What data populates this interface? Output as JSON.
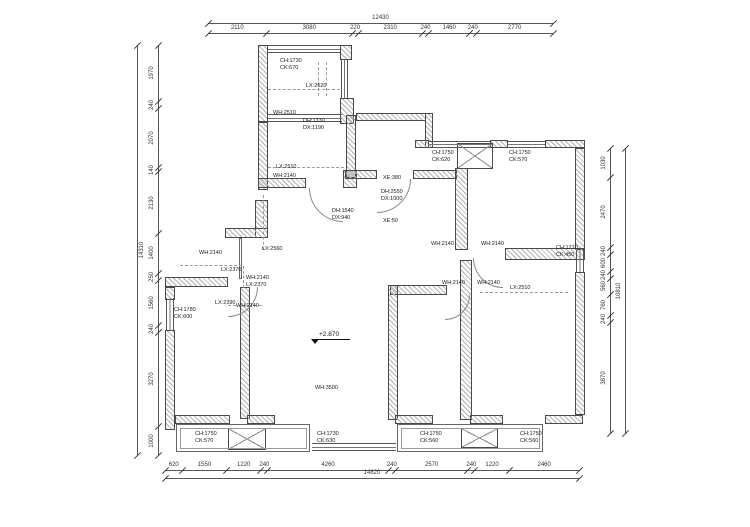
{
  "drawing": {
    "level_marker": "+2.870",
    "dimensions": {
      "top": {
        "total": "12430",
        "segments": [
          "2110",
          "3080",
          "220",
          "2310",
          "240",
          "1460",
          "240",
          "2770"
        ]
      },
      "bottom": {
        "total": "14820",
        "segments": [
          "620",
          "1550",
          "1220",
          "240",
          "4260",
          "240",
          "2570",
          "240",
          "1220",
          "2460"
        ]
      },
      "left": {
        "total": "14310",
        "segments": [
          "1970",
          "240",
          "2070",
          "140",
          "2130",
          "1400",
          "250",
          "1560",
          "240",
          "3270",
          "1000"
        ]
      },
      "right": {
        "total": "10810",
        "segments": [
          "1030",
          "2470",
          "240",
          "600",
          "240",
          "560",
          "760",
          "240",
          "3870"
        ]
      }
    },
    "annotations": [
      {
        "x": 280,
        "y": 58,
        "lines": [
          "CH:1730",
          "CK:670"
        ]
      },
      {
        "x": 306,
        "y": 83,
        "lines": [
          "LX:2620"
        ]
      },
      {
        "x": 273,
        "y": 110,
        "lines": [
          "WH:2510"
        ]
      },
      {
        "x": 303,
        "y": 118,
        "lines": [
          "DH:1330",
          "DX:1190"
        ]
      },
      {
        "x": 276,
        "y": 164,
        "lines": [
          "LX:2510"
        ]
      },
      {
        "x": 273,
        "y": 173,
        "lines": [
          "WH:2140"
        ]
      },
      {
        "x": 383,
        "y": 175,
        "lines": [
          "XE:380"
        ]
      },
      {
        "x": 381,
        "y": 189,
        "lines": [
          "DH:2550",
          "DX:1000"
        ]
      },
      {
        "x": 332,
        "y": 208,
        "lines": [
          "DH:1540",
          "DX:940"
        ]
      },
      {
        "x": 383,
        "y": 218,
        "lines": [
          "XE:50"
        ]
      },
      {
        "x": 432,
        "y": 150,
        "lines": [
          "CH:1750",
          "CK:620"
        ]
      },
      {
        "x": 509,
        "y": 150,
        "lines": [
          "CH:1750",
          "CK:570"
        ]
      },
      {
        "x": 431,
        "y": 241,
        "lines": [
          "WH:2140"
        ]
      },
      {
        "x": 481,
        "y": 241,
        "lines": [
          "WH:2140"
        ]
      },
      {
        "x": 199,
        "y": 250,
        "lines": [
          "WH:2140"
        ]
      },
      {
        "x": 262,
        "y": 246,
        "lines": [
          "LX:2560"
        ]
      },
      {
        "x": 221,
        "y": 267,
        "lines": [
          "LX:2370"
        ]
      },
      {
        "x": 246,
        "y": 275,
        "lines": [
          "WH:2140",
          "LX:2370"
        ]
      },
      {
        "x": 215,
        "y": 300,
        "lines": [
          "LX:2390"
        ]
      },
      {
        "x": 236,
        "y": 303,
        "lines": [
          "WH:2140"
        ]
      },
      {
        "x": 174,
        "y": 307,
        "lines": [
          "CH:1780",
          "CK:600"
        ]
      },
      {
        "x": 556,
        "y": 245,
        "lines": [
          "CH:1710",
          "CK:450"
        ]
      },
      {
        "x": 442,
        "y": 280,
        "lines": [
          "WH:2140"
        ]
      },
      {
        "x": 477,
        "y": 280,
        "lines": [
          "WH:2140"
        ]
      },
      {
        "x": 510,
        "y": 285,
        "lines": [
          "LX:2510"
        ]
      },
      {
        "x": 315,
        "y": 385,
        "lines": [
          "WH:3500"
        ]
      },
      {
        "x": 195,
        "y": 431,
        "lines": [
          "CH:1750",
          "CK:570"
        ]
      },
      {
        "x": 317,
        "y": 431,
        "lines": [
          "CH:1730",
          "CK:630"
        ]
      },
      {
        "x": 420,
        "y": 431,
        "lines": [
          "CH:1750",
          "CK:560"
        ]
      },
      {
        "x": 520,
        "y": 431,
        "lines": [
          "CH:1750",
          "CK:560"
        ]
      }
    ]
  }
}
